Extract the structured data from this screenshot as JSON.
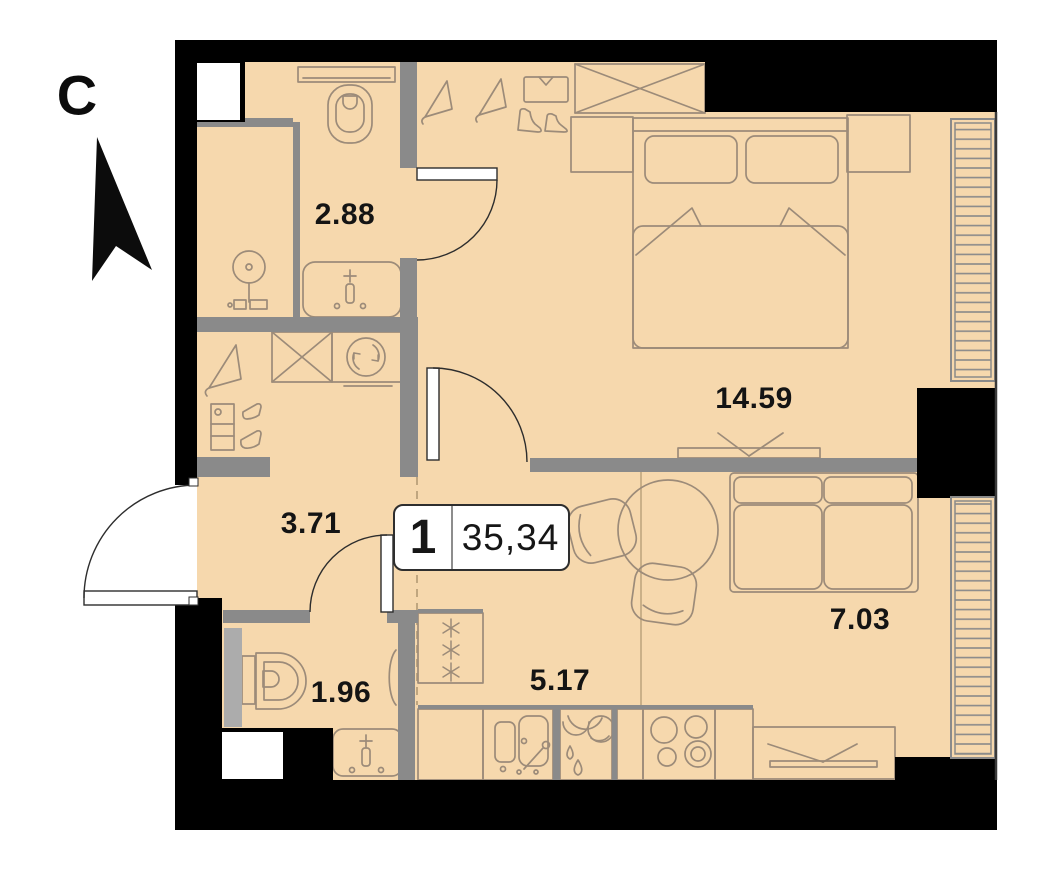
{
  "floorplan": {
    "compass": {
      "north_label": "С"
    },
    "unit_badge": {
      "rooms_count": "1",
      "total_area": "35,34"
    },
    "room_areas": {
      "bathroom_top": "2.88",
      "bedroom": "14.59",
      "hallway": "3.71",
      "bathroom_bottom": "1.96",
      "kitchen": "5.17",
      "living_room": "7.03"
    },
    "colors": {
      "floor": "#F6D8AD",
      "exterior_wall": "#000000",
      "interior_wall": "#8A8A8A",
      "furniture_line": "#9C8B79",
      "label_text": "#141414",
      "shaft_white": "#FFFFFF"
    },
    "icons": [
      "north-arrow-icon",
      "shower-icon",
      "toilet-icon",
      "washbasin-icon",
      "shelf-icon",
      "hanger-icon",
      "shirt-icon",
      "boots-icon",
      "wardrobe-icon",
      "washing-machine-icon",
      "bed-icon",
      "nightstand-icon",
      "tv-icon",
      "sofa-icon",
      "dining-table-icon",
      "chair-icon",
      "fridge-icon",
      "kitchen-sink-icon",
      "stove-icon",
      "window-hatch-icon",
      "door-arc-icon"
    ]
  }
}
